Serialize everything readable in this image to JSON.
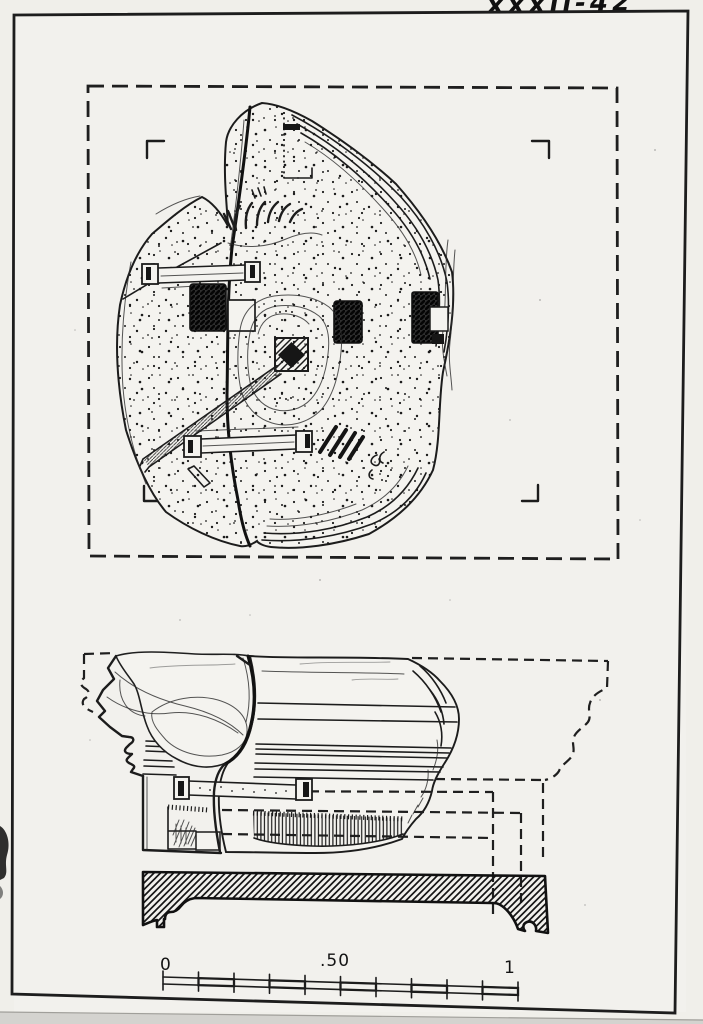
{
  "plate": {
    "handwritten_number": "XXXII-42"
  },
  "scale_bar": {
    "start_label": "0",
    "middle_label": ".50",
    "end_label": "1"
  },
  "colors": {
    "ink": "#1c1c1c",
    "paper": "#f0efea",
    "frame_border": "#1d1d1d"
  }
}
